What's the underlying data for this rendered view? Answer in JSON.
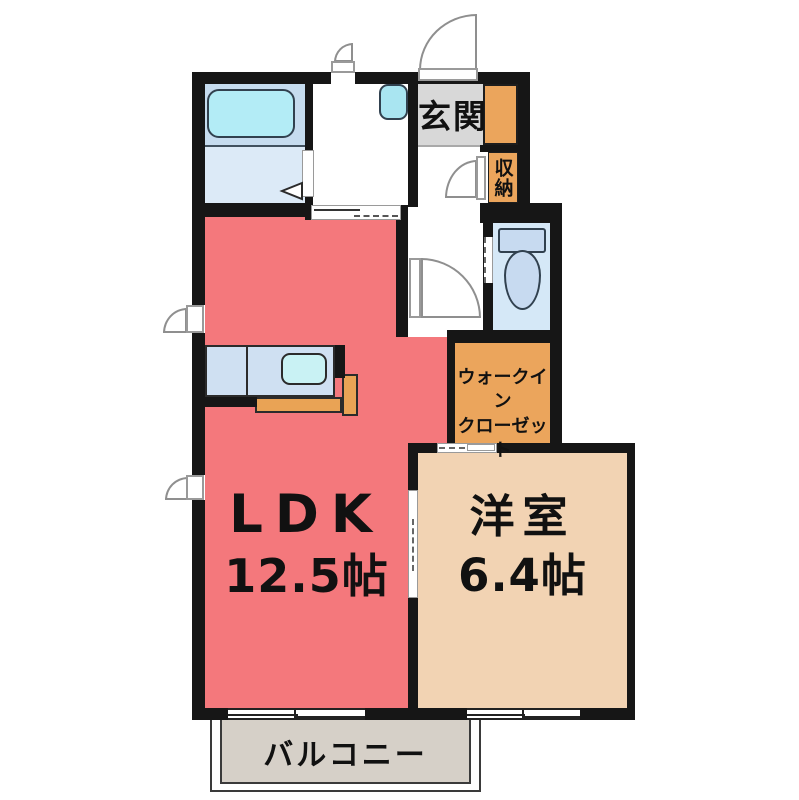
{
  "floorplan": {
    "rooms": {
      "genkan": {
        "label": "玄関"
      },
      "shuno": {
        "label": "収納"
      },
      "wic": {
        "label_line1": "ウォークイン",
        "label_line2": "クローゼット"
      },
      "ldk": {
        "label": "LDK",
        "size": "12.5帖"
      },
      "western_room": {
        "label": "洋室",
        "size": "6.4帖"
      },
      "balcony": {
        "label": "バルコニー"
      }
    },
    "fixtures": [
      "bathtub",
      "washbasin",
      "toilet",
      "kitchen-sink",
      "kitchen-counter"
    ],
    "colors": {
      "wall": "#161616",
      "ldk_pink": "#f4787c",
      "western_beige": "#f2d3b3",
      "storage_orange": "#eba55c",
      "genkan_gray": "#d8d8d8",
      "balcony_gray": "#d6d0c8",
      "bath_floor_upper": "#c6dcef",
      "bath_floor_lower": "#dceaf7",
      "toilet_floor": "#d5e8f7",
      "tub_cyan": "#b3ecf6",
      "counter_blue": "#cfe0f2",
      "sink_cyan": "#c9f2f4",
      "counter_orange": "#e9a355"
    }
  }
}
